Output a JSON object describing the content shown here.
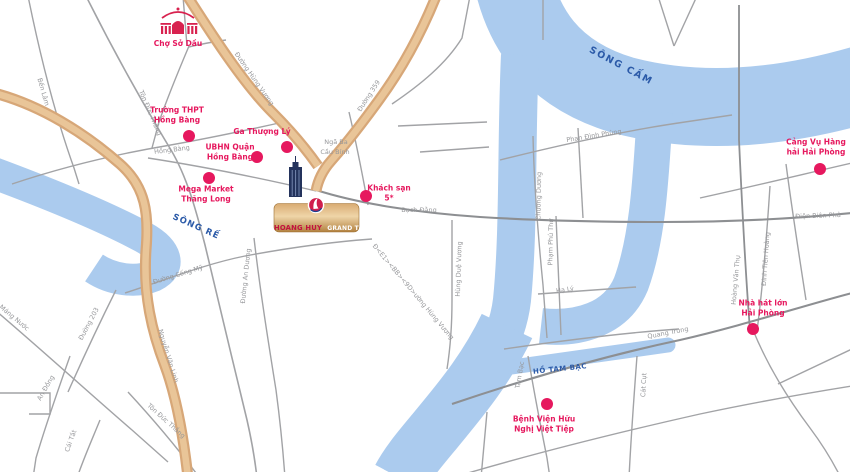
{
  "map": {
    "colors": {
      "background": "#ffffff",
      "water": "#abcbee",
      "water_label": "#2b5aa8",
      "poi_accent": "#e6185e",
      "road_minor": "#a2a3a6",
      "road_major": "#8d8f92",
      "road_tan_outer": "#d7a778",
      "road_tan_inner": "#e9c598",
      "card_gold": "#d9ab72",
      "tower_navy": "#24335c"
    },
    "landmark": {
      "name": "HOANG HUY",
      "suffix": "GRAND TOWER"
    },
    "water_labels": [
      {
        "text": "SÔNG CẤM"
      },
      {
        "text": "SÔNG RẾ"
      },
      {
        "text": "HỒ TAM BẠC"
      }
    ],
    "pois": [
      {
        "id": "cho-so-dau",
        "label_lines": [
          "Chợ Sở Dầu"
        ]
      },
      {
        "id": "truong-thpt-hong-bang",
        "label_lines": [
          "Trường THPT",
          "Hồng Bàng"
        ]
      },
      {
        "id": "ga-thuong-ly",
        "label_lines": [
          "Ga  Thượng Lý"
        ]
      },
      {
        "id": "ubnd-quan-hong-bang",
        "label_lines": [
          "UBHN Quận",
          "Hồng Bàng"
        ]
      },
      {
        "id": "mega-market-thang-long",
        "label_lines": [
          "Mega Market",
          "Thăng Long"
        ]
      },
      {
        "id": "khach-san-5-sao",
        "label_lines": [
          "Khách sạn",
          "5*"
        ]
      },
      {
        "id": "cang-vu-hang-hai",
        "label_lines": [
          "Cảng Vụ Hàng",
          "hải Hải Phòng"
        ]
      },
      {
        "id": "nha-hat-lon",
        "label_lines": [
          "Nhà hát lớn",
          "Hải Phòng"
        ]
      },
      {
        "id": "benh-vien-viet-tiep",
        "label_lines": [
          "Bệnh Viện Hữu",
          "Nghị Việt Tiệp"
        ]
      }
    ],
    "streets": [
      {
        "text": "Bến Lâm"
      },
      {
        "text": "Tôn Đức Thắng"
      },
      {
        "text": "Hồng Bàng"
      },
      {
        "text": "Đường Hùng Vương"
      },
      {
        "text": "Đường 359"
      },
      {
        "text": "Ngã Ba"
      },
      {
        "text": "Cầu Bính"
      },
      {
        "text": "Bạch Đằng"
      },
      {
        "text": "Hùng Duệ Vương"
      },
      {
        "text": "Đ<E1><BB><9D>ường Hùng Vương"
      },
      {
        "text": "Chương Dương"
      },
      {
        "text": "Phạm Phú Thứ"
      },
      {
        "text": "Phan Đình Phùng"
      },
      {
        "text": "Hạ Lý"
      },
      {
        "text": "Điện Biên Phủ"
      },
      {
        "text": "Hoàng Văn Thụ"
      },
      {
        "text": "Đinh Tiên Hoàng"
      },
      {
        "text": "Quang Trung"
      },
      {
        "text": "Cát Cụt"
      },
      {
        "text": "Tam Bạc"
      },
      {
        "text": "Máng Nước"
      },
      {
        "text": "Đường 203"
      },
      {
        "text": "An Đồng"
      },
      {
        "text": "Cái Tắt"
      },
      {
        "text": "Tôn Đức Thắng"
      },
      {
        "text": "Nguyễn Văn Linh"
      },
      {
        "text": "Đường Cống Mỹ"
      },
      {
        "text": "Đường An Dương"
      }
    ]
  }
}
